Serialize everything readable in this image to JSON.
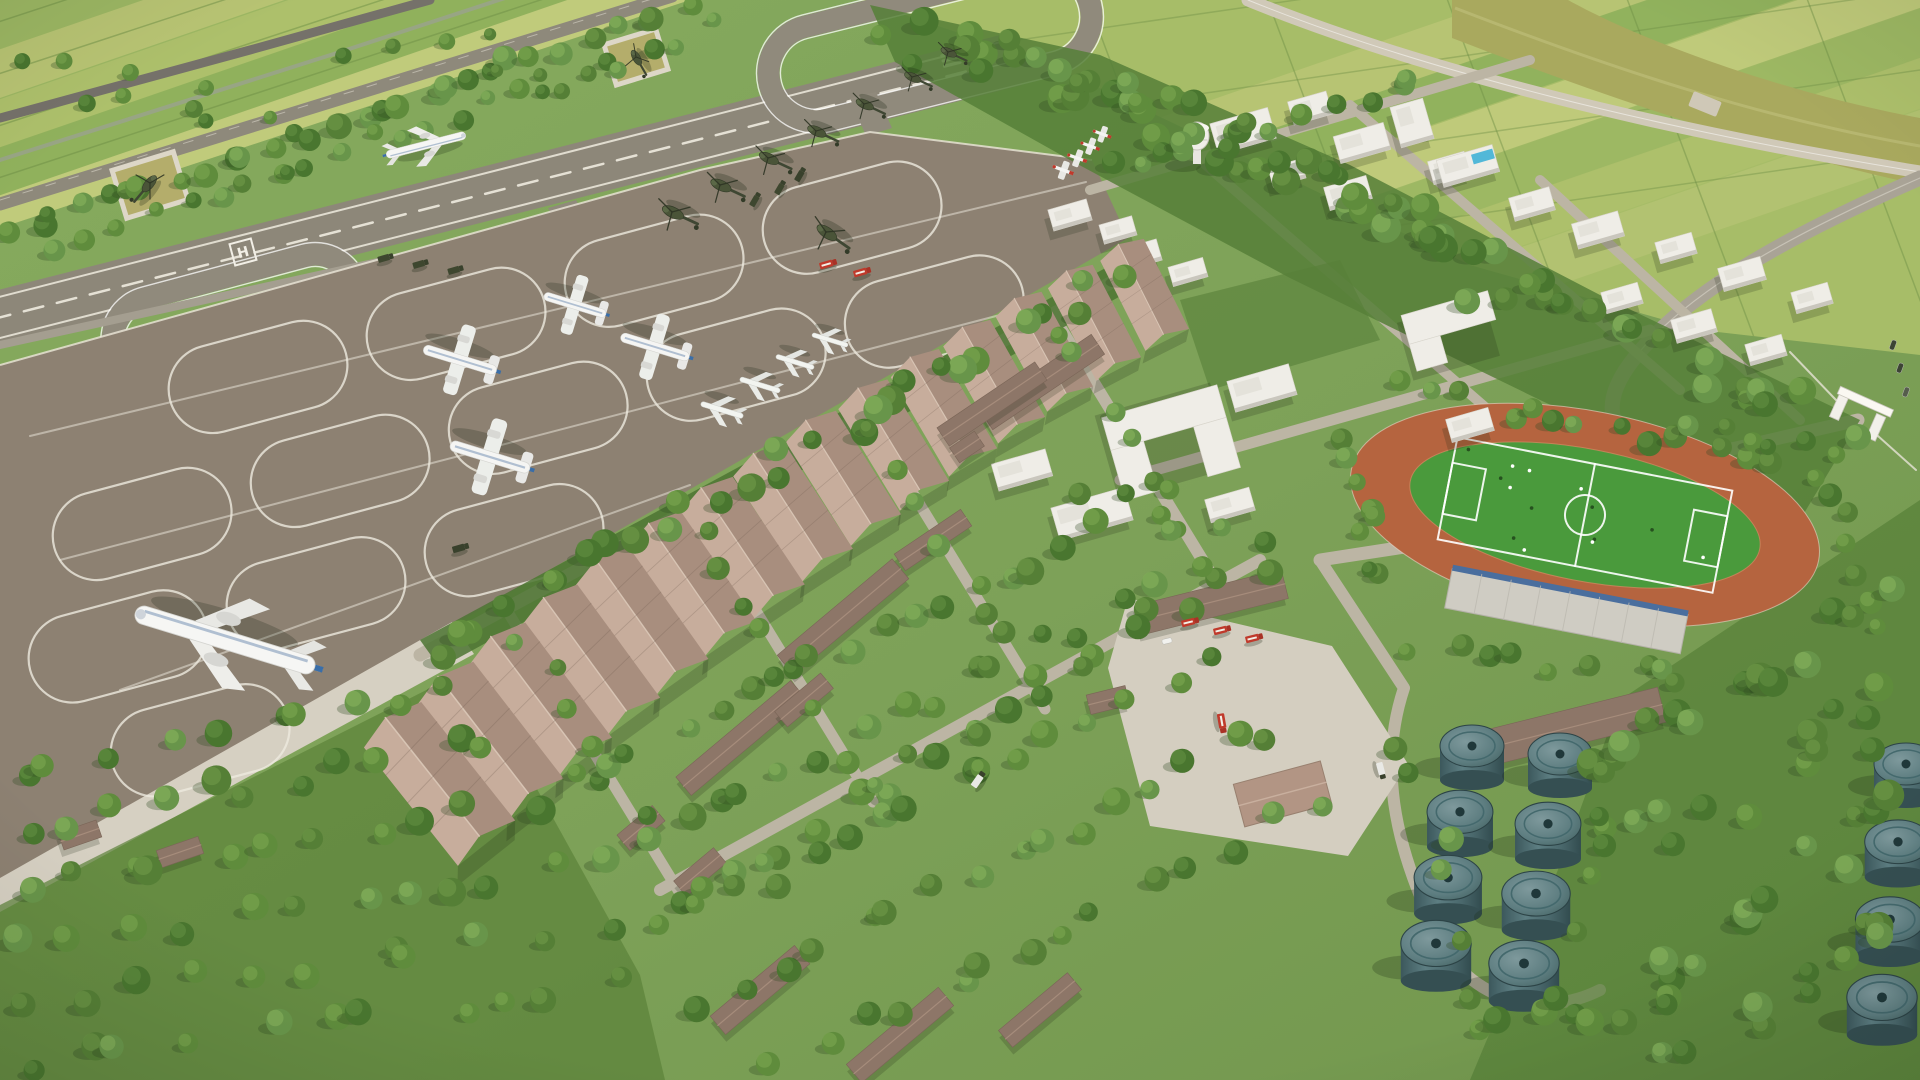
{
  "scene": {
    "type": "aerial-3d-architectural-rendering",
    "subject": "military airbase campus: runway, taxiway loops, parking apron with aircraft and helicopters, hangar row, barracks campus, stadium, fuel tank farm, farmland beyond perimeter",
    "markings": {
      "helipad_letter": "H"
    },
    "counts": {
      "runways": 1,
      "taxiway_loops": 2,
      "display_helipads": 2,
      "parked_helicopters": 8,
      "turboprop_aircraft": 4,
      "small_jets": 4,
      "trainer_aircraft": 4,
      "airliner_taxiing": 1,
      "aircraft_on_runway": 1,
      "hangars": 15,
      "fuel_tanks": 12,
      "fire_trucks": 6,
      "soccer_fields": 1,
      "running_tracks": 1,
      "water_towers": 1,
      "swimming_pools": 1
    },
    "palette": {
      "grass": "#7da158",
      "grass_dark": "#6f954c",
      "field_a": "#b9c474",
      "field_b": "#9cb763",
      "field_c": "#aec06c",
      "field_d": "#8fb05c",
      "canal": "#a9a95e",
      "runway": "#8d8779",
      "taxiway": "#908a7c",
      "apron": "#8d8172",
      "concrete": "#d6d0c2",
      "road_dark": "#75716a",
      "road_light": "#bcb5a4",
      "hangar_roof_light": "#c7ad9c",
      "hangar_roof_dark": "#a88e7e",
      "barrack_roof": "#8d7668",
      "building_white": "#efede7",
      "tree_dark": "#49762f",
      "tree_mid": "#5f8c3c",
      "track": "#b5643f",
      "pitch": "#4a9a3c",
      "tank_body": "#4e6d71",
      "fire_red": "#c0392b",
      "pool": "#52b8d8",
      "marking_white": "#f2efe6"
    }
  }
}
